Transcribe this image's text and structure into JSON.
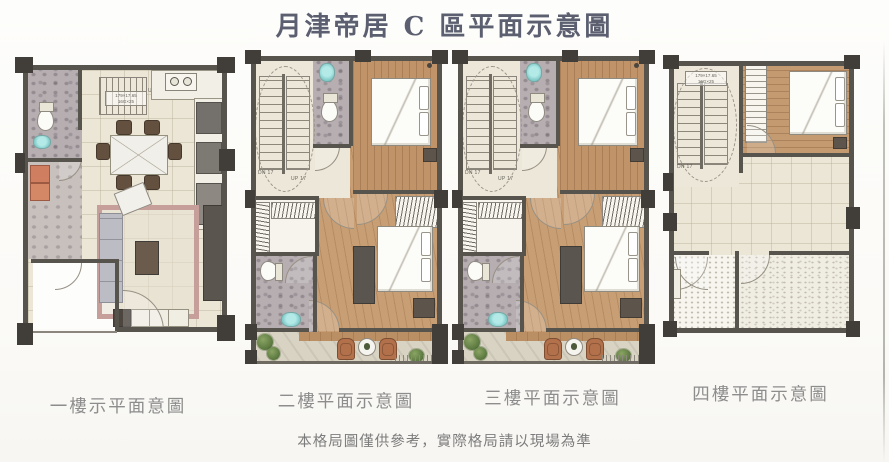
{
  "title": "月津帝居 C 區平面示意圖",
  "disclaimer": "本格局圖僅供參考，實際格局請以現場為準",
  "plans": [
    {
      "label": "一樓示平面意圖",
      "stair_up": "UP 17",
      "stair_spec_line1": "179×17.65",
      "stair_spec_line2": "16G×25"
    },
    {
      "label": "二樓平面示意圖",
      "stair_dn": "DN 17",
      "stair_up": "UP 17"
    },
    {
      "label": "三樓平面示意圖",
      "stair_dn": "DN 17",
      "stair_up": "UP 17"
    },
    {
      "label": "四樓平面示意圖",
      "stair_dn": "DN 17",
      "stair_spec_line1": "179×17.65",
      "stair_spec_line2": "16G×25"
    }
  ],
  "colors": {
    "wall": "#57534d",
    "column": "#413e3a",
    "floor_tile_cream": "#ebe6d5",
    "wood": "#c09468",
    "bath_gray": "#b6aeb1",
    "sink_teal": "#7fc9c7",
    "rug_pink": "#c79f9a",
    "plant_green": "#5d7a41",
    "chair_rust": "#b2714b",
    "title_ink": "#5b5f70",
    "label_gray": "#8d8d8d"
  }
}
